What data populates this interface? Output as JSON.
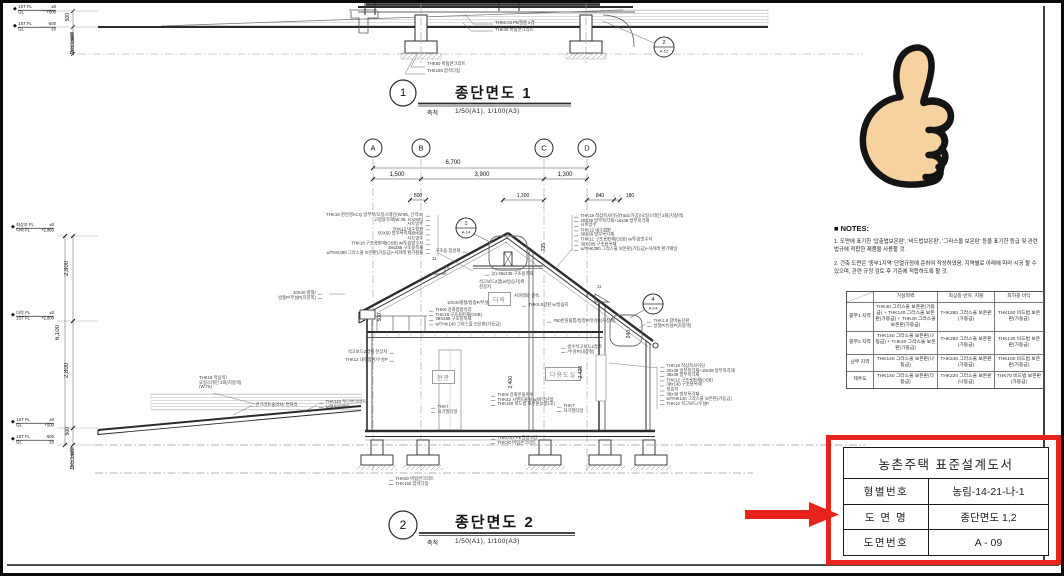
{
  "colors": {
    "red": "#e8231d",
    "line": "#2b2b2b",
    "light": "#9a9a9a",
    "skin": "#f8d29e"
  },
  "section1": {
    "title_bubble": "1",
    "title": "종단면도 1",
    "scale_label": "축척",
    "scale_value": "1/50(A1), 1/100(A3)",
    "detail_bubble": {
      "num": "2",
      "sheet": "A-12"
    },
    "levels": [
      {
        "l1": "1ST FL",
        "v1": "±0",
        "l2": "GL",
        "v2": "+500"
      },
      {
        "l1": "1ST FL",
        "v1": "-500",
        "l2": "GL",
        "v2": "±0"
      }
    ],
    "dim_frost": "500",
    "frost_text": "동결선깊이",
    "labels": {
      "pe_film": "THK0.03 PE필름 2겹",
      "lean30": "THK30 버림콘크리트",
      "lean50": "THK50 버림콘크리트",
      "gravel": "THK150 잡석다짐"
    }
  },
  "section2": {
    "title_bubble": "2",
    "title": "종단면도 2",
    "scale_label": "축척",
    "scale_value": "1/50(A1), 1/100(A3)",
    "grid": [
      "A",
      "B",
      "C",
      "D"
    ],
    "dims": {
      "total": "6,700",
      "spans": [
        "1,500",
        "3,900",
        "1,300"
      ],
      "small": [
        "500",
        "1,300",
        "840",
        "180"
      ],
      "left": [
        "2,800",
        "6,100",
        "2,800",
        "500"
      ],
      "inner": {
        "ridge": "735",
        "clerestory": "500",
        "hall": "2,400",
        "utility": "2,420",
        "eave": "240"
      }
    },
    "levels": [
      {
        "l1": "최상부 FL",
        "v1": "±0",
        "l2": "다락 FL",
        "v2": "+2,860"
      },
      {
        "l1": "다락 FL",
        "v1": "±0",
        "l2": "1ST FL",
        "v2": "+2,800"
      },
      {
        "l1": "1ST FL",
        "v1": "±0",
        "l2": "GL",
        "v2": "+500"
      },
      {
        "l1": "1ST FL",
        "v1": "-500",
        "l2": "GL",
        "v2": "±0"
      }
    ],
    "frost_text": "동결선깊이",
    "detail_bubbles": {
      "ridge": {
        "num": "1",
        "sheet": "A-14"
      },
      "eave": {
        "num": "4",
        "sheet": "A-14"
      }
    },
    "slope": {
      "run": "11",
      "rise": "6"
    },
    "rooms": {
      "attic": "다락",
      "entrance": "현관",
      "utility": "다용도실"
    },
    "roof_left_annotations": [
      "THK19 천연경ACQ 방부목/오일스테인(W:95, 간격:5)",
      "고정용각재(W:38, H:VAR.)",
      "시트방수",
      "THK12 내수합판",
      "50X50 방부목각재@450",
      "시트방수",
      "THK18 구조용판재(OSB) w/투습방수지",
      "38x285 구조용목재",
      "w/THK280 그라스울 보온판(가등급)+서까래 환기철물"
    ],
    "roof_right_annotations": [
      "THK18 적삼목사이딩(T&G/가공)/오일스테인 2회(지정색)",
      "20X38 방부목각재+18x38 방부목각재",
      "시트방수",
      "THK12 내수합판",
      "38X38 방부목각재",
      "THK12 구조용판재(OSB) w/투습방수지",
      "38X285 구조용목재",
      "w/THK280 그라스울 보온판(가등급)+서까래 환기패널"
    ],
    "wall_right_annotations": [
      "THK18 적삼목사이딩",
      "20x38 방부목각재+18x38 방부목각재",
      "38x38 방부목각재",
      "THK12 구조용판재(OSB)",
      "38x140 구조용목재",
      "방습지",
      "38x38 방부목각재",
      "w/THK140 그라스울 보온판(가등급)",
      "THK12 석고보드/수성P"
    ],
    "flat_bar_lines": [
      "10X40 평철/",
      "방충P/무설P(지붕쪽)"
    ],
    "flat_bar30": "10X30평철/방충P/무설P",
    "ridge_labels": {
      "glulam": "구조용 집성재",
      "rafter": "(2)-38x235 구조용목재",
      "ceiling_lines": [
        "석고보드2겹(w/방습지)위",
        "천장지"
      ],
      "tie": "서까래와 결속"
    },
    "entrance_labels": [
      "THK6 강화접합유리",
      "THK18 구조용판재(OSB)",
      "38X285 구조용목재",
      "w/THK140 그라스울 보온판(가등급)"
    ],
    "left_wall_labels": [
      "석고보드2겹위 천장지",
      "THK12 내수합판/수성P"
    ],
    "plywood_label": "THK9.5합판 w/방습지",
    "gutter_label": "#50반원홈통/방청P/유성P(지정색)",
    "wgb_lines": [
      "방수석고보드2겹위",
      "/수성P(내장칠)"
    ],
    "galv_lines": [
      "THK1.6 갈바늄강판",
      "방청P/유성P(지정색)"
    ],
    "deck_label_lines": [
      "THK18 적삼목/",
      "오일스테인 2회(지정색)",
      "(W:75)"
    ],
    "slab_label": "콘크리트슬라브/ 면처리",
    "plain_concrete_lines": [
      "THK110 무근콘크리트",
      "w/와이어메쉬"
    ],
    "tile_lines": [
      "THK7",
      "자기질타일"
    ],
    "floor_labels": [
      "THK8 강화온돌마루",
      "THK42 시멘트몰탈 w/바닥난방",
      "THK150 비드법 보온판(2종1호)"
    ],
    "under_labels": [
      "THK0.03 PE필름 2겹",
      "THK30 버림콘크리트"
    ],
    "footing_labels": [
      "THK50 버림콘크리트",
      "THK150 잡석다짐"
    ]
  },
  "notes": {
    "heading": "■ NOTES:",
    "items": [
      "1. 도면에 표기한 '압출법보온판', '비드법보온판', '그라스울 보온판' 등을 표기한 등급 및 관련 법규에 적합한 제품을 사용할 것.",
      "2. 건축 도면은 '중부1지역' 단열규정에 준하여 작성하였음. 지역별로 아래에 따라 시공 할 수 있으며, 관련 규정 검토 후 기준에 적합하도록 할 것."
    ]
  },
  "insulation_table": {
    "headers": [
      "",
      "거실외벽",
      "최상층 반자, 지붕",
      "최하층 바닥"
    ],
    "rows": [
      {
        "region": "중부1 지역",
        "wall": "THK40 그라스울 보온판(가등급) + THK140 그라스울 보온판(가등급) + THK40 그라스울 보온판(가등급)",
        "roof": "THK280 그라스울 보온판(가등급)",
        "floor": "THK150 비드법 보온판(가등급)"
      },
      {
        "region": "중부2 지역",
        "wall": "THK140 그라스울 보온판(나등급) + THK40 그라스울 보온판(가등급)",
        "roof": "THK280 그라스울 보온판(가등급)",
        "floor": "THK130 비드법 보온판(가등급)"
      },
      {
        "region": "남부 지역",
        "wall": "THK140 그라스울 보온판(나등급)",
        "roof": "THK240 그라스울 보온판(가등급)",
        "floor": "THK100 비드법 보온판(가등급)"
      },
      {
        "region": "제주도",
        "wall": "THK140 그라스울 보온판(다등급)",
        "roof": "THK220 그라스울 보온판(나등급)",
        "floor": "THK70 비드법 보온판(가등급)"
      }
    ]
  },
  "title_block": {
    "title": "농촌주택 표준설계도서",
    "rows": [
      {
        "label": "형별번호",
        "value": "농림-14-21-나-1"
      },
      {
        "label": "도 면 명",
        "value": "종단면도 1,2"
      },
      {
        "label": "도면번호",
        "value": "A - 09"
      }
    ]
  }
}
